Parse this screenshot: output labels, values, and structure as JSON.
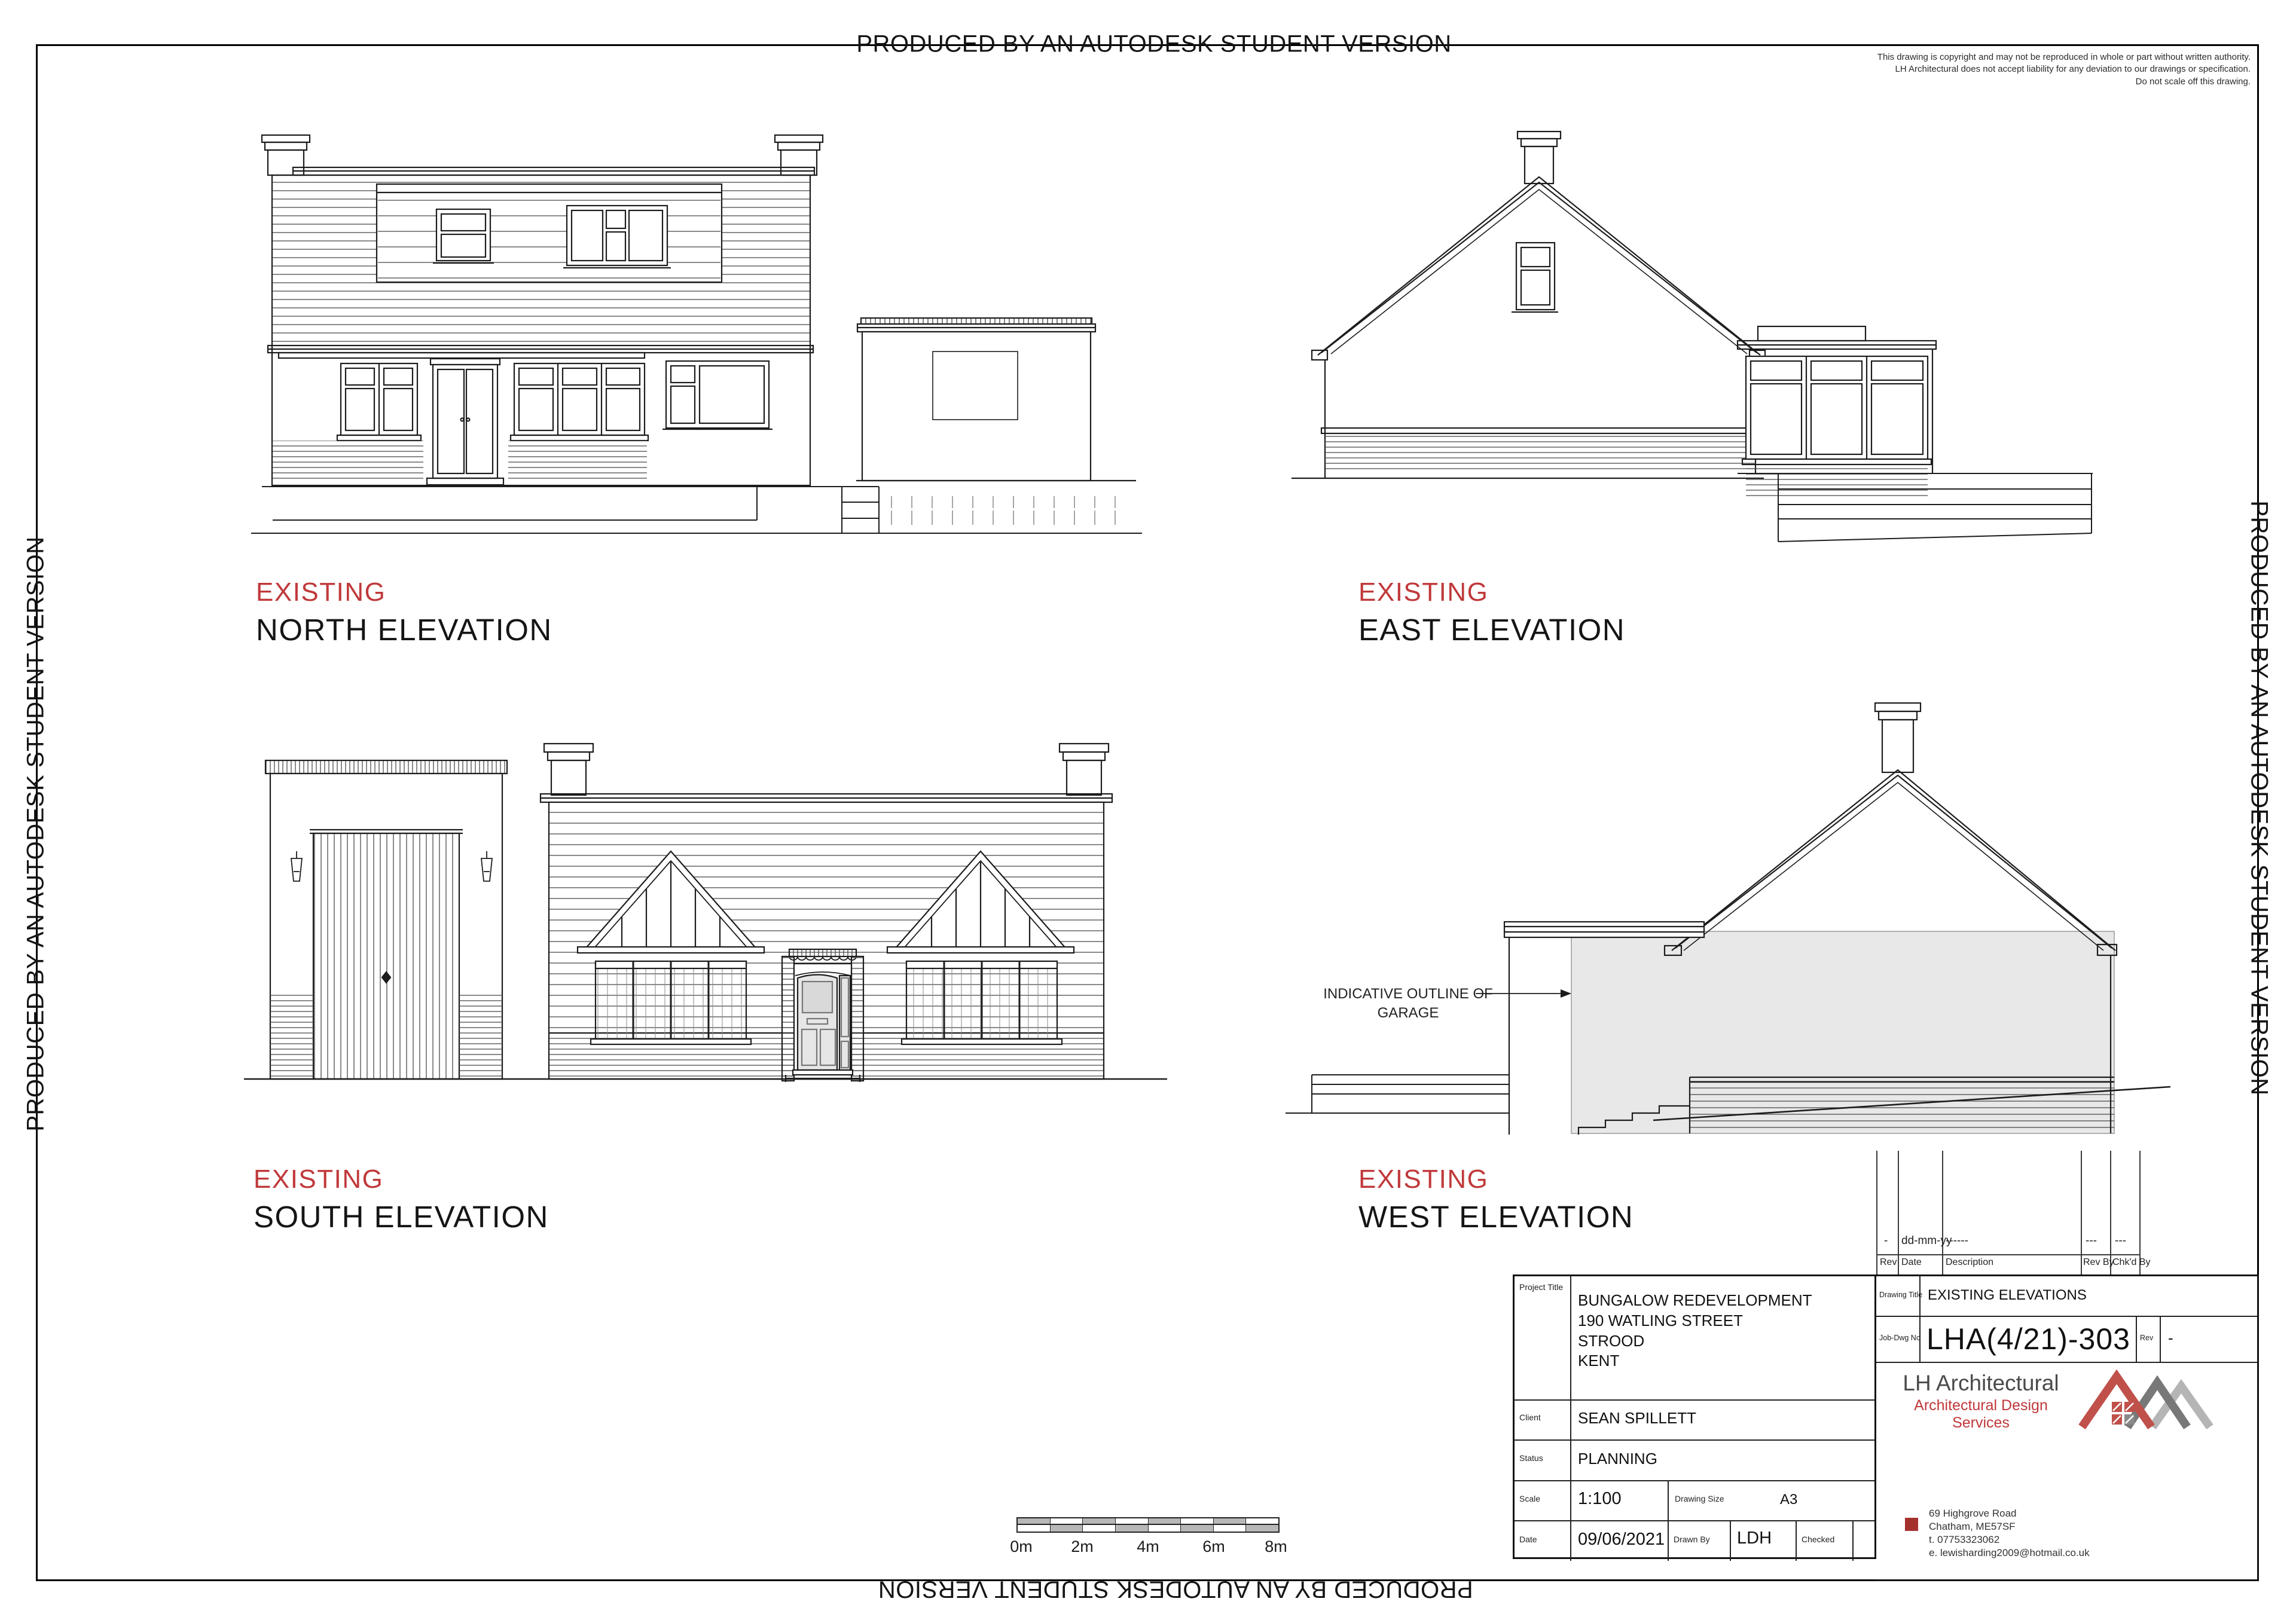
{
  "watermark": {
    "text": "PRODUCED BY AN AUTODESK STUDENT VERSION"
  },
  "disclaimer": {
    "lines": [
      "This drawing is copyright and may not be reproduced in whole or part without written authority.",
      "LH Architectural does not accept liability for any deviation to our drawings or specification.",
      "Do not scale off this drawing."
    ]
  },
  "elevations": [
    {
      "status": "EXISTING",
      "title": "NORTH ELEVATION"
    },
    {
      "status": "EXISTING",
      "title": "EAST ELEVATION"
    },
    {
      "status": "EXISTING",
      "title": "SOUTH ELEVATION"
    },
    {
      "status": "EXISTING",
      "title": "WEST ELEVATION"
    }
  ],
  "annotations": {
    "garage_outline": [
      "INDICATIVE OUTLINE OF",
      "GARAGE"
    ]
  },
  "scale_bar": {
    "labels": [
      "0m",
      "2m",
      "4m",
      "6m",
      "8m"
    ]
  },
  "revision_table": {
    "headers": [
      "Rev",
      "Date",
      "Description",
      "Rev By",
      "Chk'd By"
    ],
    "rows": [
      {
        "rev": "-",
        "date": "dd-mm-yy",
        "description": "------",
        "rev_by": "---",
        "chkd_by": "---"
      }
    ]
  },
  "title_block": {
    "labels": {
      "project_title": "Project Title",
      "client": "Client",
      "status": "Status",
      "scale": "Scale",
      "drawing_size": "Drawing Size",
      "date": "Date",
      "drawn_by": "Drawn By",
      "checked": "Checked",
      "drawing_title": "Drawing Title",
      "job_dwg_no": "Job-Dwg No",
      "rev": "Rev"
    },
    "project_title_lines": [
      "BUNGALOW REDEVELOPMENT",
      "190 WATLING STREET",
      "STROOD",
      "KENT"
    ],
    "client": "SEAN SPILLETT",
    "status": "PLANNING",
    "scale": "1:100",
    "drawing_size": "A3",
    "date": "09/06/2021",
    "drawn_by": "LDH",
    "checked": "",
    "drawing_title": "EXISTING ELEVATIONS",
    "job_dwg_no": "LHA(4/21)-303",
    "rev": "-"
  },
  "firm": {
    "name": "LH Architectural",
    "tagline": "Architectural Design Services",
    "address_lines": [
      "69 Highgrove Road",
      "Chatham, ME57SF",
      "t.  07753323062",
      "e. lewisharding2009@hotmail.co.uk"
    ]
  },
  "colors": {
    "accent_red": "#c0393b",
    "logo_red": "#c0504a",
    "logo_dark": "#787878",
    "logo_light": "#b5b5b5",
    "bullet_red": "#a5312d",
    "line": "#1c1c1c",
    "garage_fill": "#e8e8e8",
    "scalebar_gray": "#b8b8b8"
  }
}
